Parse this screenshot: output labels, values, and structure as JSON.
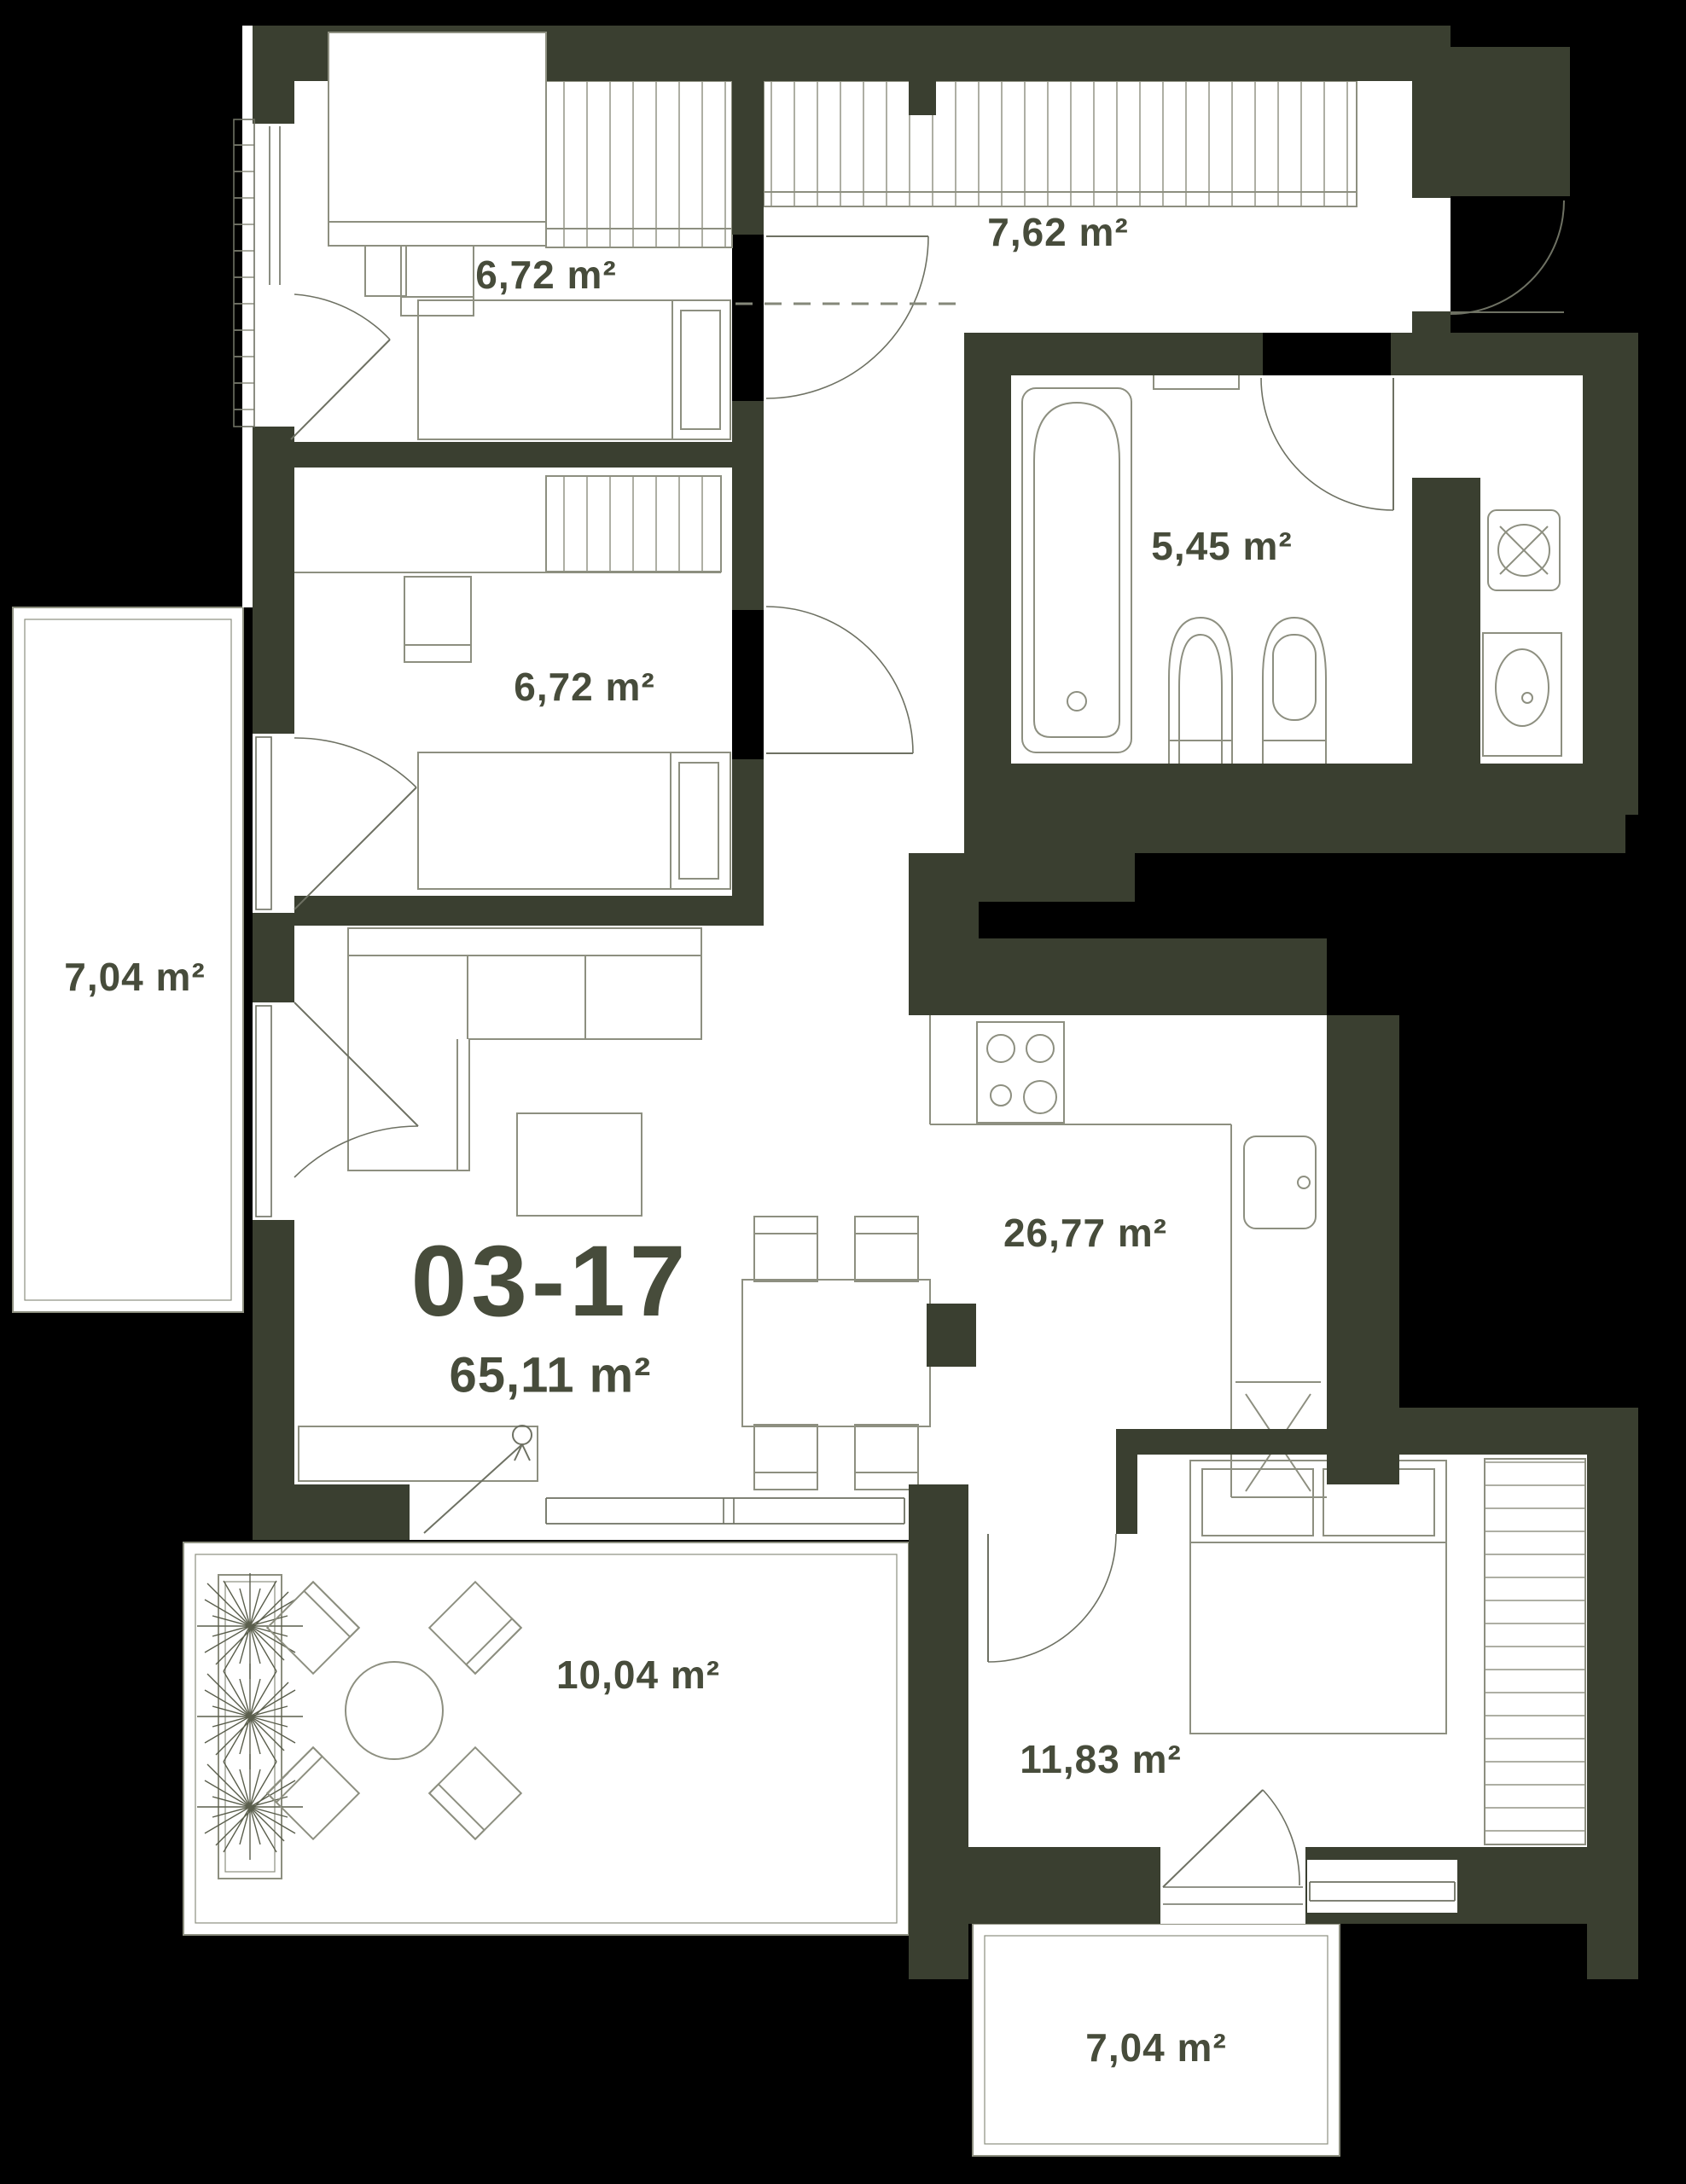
{
  "unit": {
    "code": "03-17",
    "total_area": "65,11 m²"
  },
  "rooms": [
    {
      "id": "bedroom-1",
      "area": "6,72 m²"
    },
    {
      "id": "hallway",
      "area": "7,62 m²"
    },
    {
      "id": "bathroom",
      "area": "5,45 m²"
    },
    {
      "id": "bedroom-2",
      "area": "6,72 m²"
    },
    {
      "id": "balcony-left",
      "area": "7,04 m²"
    },
    {
      "id": "living-kitchen",
      "area": "26,77 m²"
    },
    {
      "id": "terrace",
      "area": "10,04 m²"
    },
    {
      "id": "bedroom-3",
      "area": "11,83 m²"
    },
    {
      "id": "balcony-bottom",
      "area": "7,04 m²"
    }
  ],
  "colors": {
    "background": "#000000",
    "wall": "#3a3f30",
    "floor": "#ffffff",
    "label_text": "#474c3b",
    "furniture_line": "#8d8f80"
  }
}
